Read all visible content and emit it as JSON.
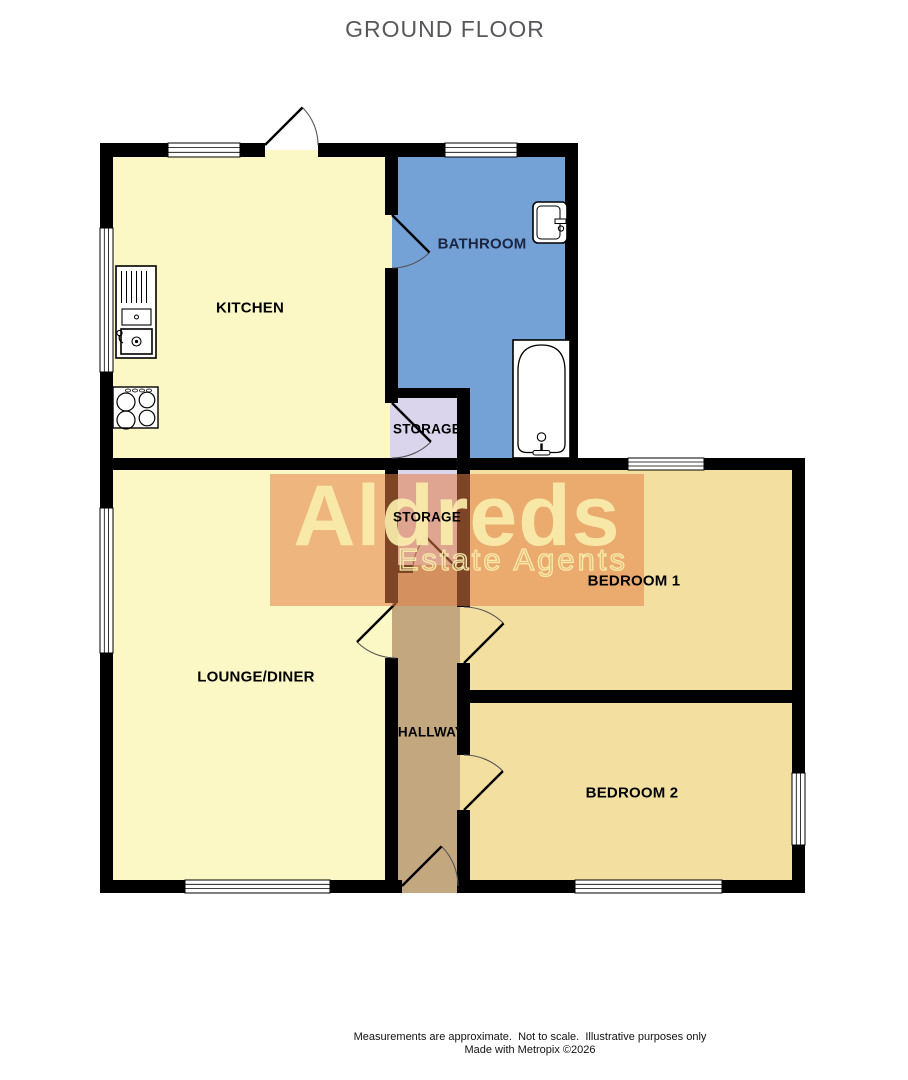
{
  "title": "GROUND FLOOR",
  "watermark": {
    "line1": "Aldreds",
    "line2": "Estate Agents",
    "overlay_color": "rgba(228,126,70,0.55)"
  },
  "rooms": {
    "kitchen": {
      "label": "KITCHEN",
      "color": "#FBF8C6",
      "label_color": "#000000"
    },
    "bathroom": {
      "label": "BATHROOM",
      "color": "#74A1D6",
      "label_color": "#1B2742"
    },
    "storage1": {
      "label": "STORAGE",
      "color": "#DAD5EC",
      "label_color": "#000000"
    },
    "storage2": {
      "label": "STORAGE",
      "color": "#DAD5EC",
      "label_color": "#000000"
    },
    "lounge": {
      "label": "LOUNGE/DINER",
      "color": "#FBF8C6",
      "label_color": "#000000"
    },
    "hallway": {
      "label": "HALLWAY",
      "color": "#C3A77F",
      "label_color": "#000000"
    },
    "bedroom1": {
      "label": "BEDROOM 1",
      "color": "#F3E0A1",
      "label_color": "#000000"
    },
    "bedroom2": {
      "label": "BEDROOM 2",
      "color": "#F3E0A1",
      "label_color": "#000000"
    }
  },
  "colors": {
    "wall": "#000000",
    "window_fill": "#FFFFFF",
    "door_line": "#000000",
    "door_arc": "#555555",
    "fixture_fill": "#FFFFFF",
    "fixture_stroke": "#000000"
  },
  "icons": [
    "kitchen-sink-icon",
    "hob-icon",
    "basin-icon",
    "bathtub-icon",
    "window",
    "door-swing"
  ],
  "footer": {
    "line1": "Measurements are approximate.  Not to scale.  Illustrative purposes only",
    "line2": "Made with Metropix ©2026"
  }
}
